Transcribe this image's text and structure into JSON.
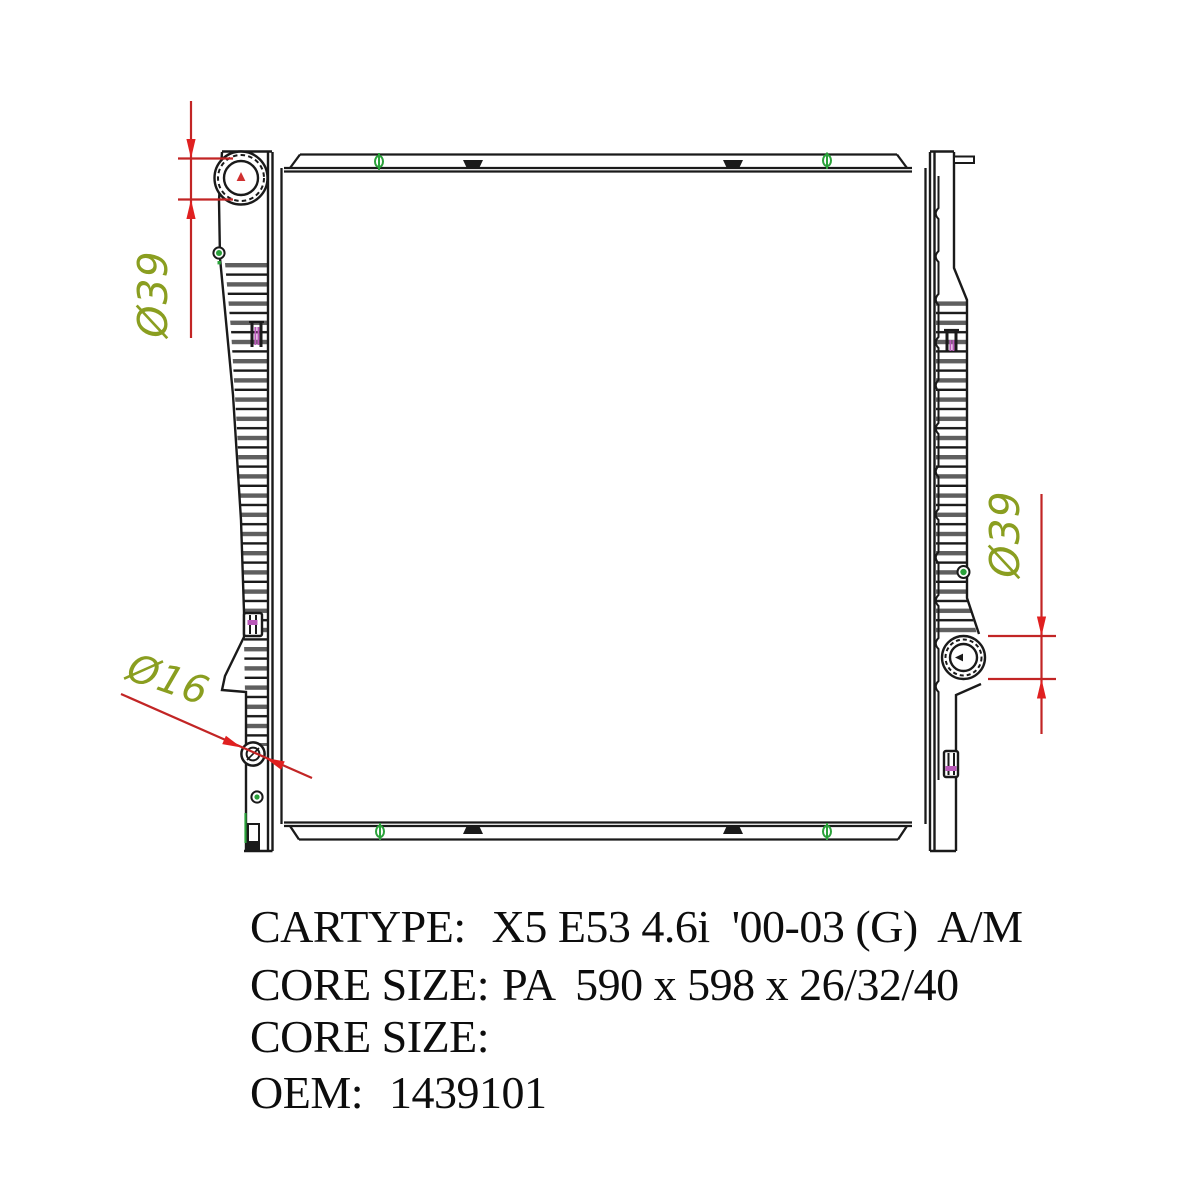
{
  "drawing": {
    "type": "radiator-technical-line-drawing",
    "dimensions": {
      "top_left": {
        "label": "Ø39"
      },
      "right": {
        "label": "Ø39"
      },
      "bottom_left": {
        "label": "Ø16"
      }
    },
    "colors": {
      "outline": "#1a1a1a",
      "rib_gray": "#5f5f5f",
      "fastener_green": "#2aa13a",
      "clip_magenta": "#b959b9",
      "dimension_line_red": "#c22525",
      "arrow_red": "#e02020",
      "dimension_text_olive": "#8a9e20",
      "cap_marker_red": "#d03030"
    }
  },
  "specs": {
    "lines": [
      {
        "label": "CARTYPE:",
        "value": "X5 E53 4.6i  '00-03 (G)  A/M"
      },
      {
        "label": "CORE SIZE:",
        "value": "PA  590 x 598 x 26/32/40"
      },
      {
        "label": "CORE SIZE:",
        "value": ""
      },
      {
        "label": "OEM:",
        "value": "1439101"
      }
    ]
  }
}
